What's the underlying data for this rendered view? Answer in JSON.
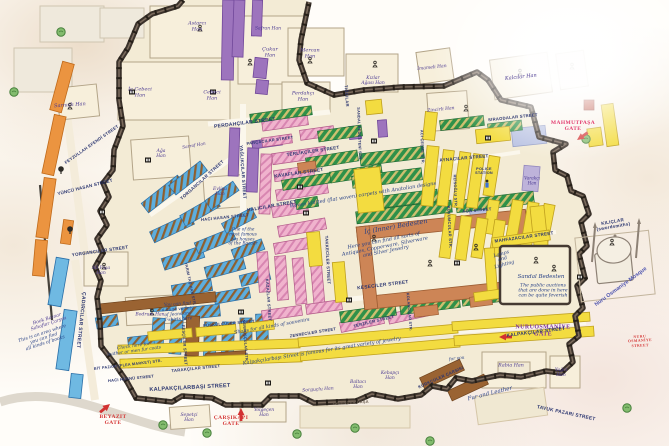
{
  "ic_bedesten": {
    "title": "İç (Inner) Bedesten",
    "note": "Here you can find all sorts of\nAntiques, Copperware, Silverware\nand Silver Jewelry"
  },
  "sandal_bedesten": {
    "title": "Sandal Bedesten",
    "note": "The public auctions\nthat are done in here\ncan be quite feverish"
  },
  "notes": {
    "carpets": "Woven knitted (flat woven) carpets with Anatolian designs",
    "jewelry": "Kalpakçılarbaşı Street is famous for its great variety of jewelry"
  },
  "mosque": {
    "label": "Nuru Osmaniye Mosque"
  },
  "colors": {
    "street_text": "#2a3570",
    "han_text": "#4b3a92",
    "note_text": "#274086",
    "gate_red": "#d43333",
    "gate_magenta": "#e23b6e",
    "gate_purple": "#7b2fa0",
    "yellow": "#f3dc40",
    "pink": "#f0b3cd",
    "green": "#2f9149",
    "blue": "#5caede",
    "purple": "#9d74bd",
    "orange": "#eb9440",
    "brick": "#cd8556",
    "wall": "#3b322b"
  },
  "labels": [
    {
      "cls": "gate",
      "name": "gate-label",
      "items": [
        {
          "t": "MAHMUTPAŞA\nGATE",
          "x": 573,
          "y": 126,
          "c": "#e23b6e",
          "fs": 5.5
        },
        {
          "t": "NURUOSMANİYE\nGATE",
          "x": 543,
          "y": 331,
          "c": "#7b2fa0",
          "fs": 6
        },
        {
          "t": "BEYAZIT\nGATE",
          "x": 113,
          "y": 420,
          "c": "#d43333",
          "fs": 5.5
        },
        {
          "t": "ÇARŞIKAPI\nGATE",
          "x": 231,
          "y": 421,
          "c": "#d43333",
          "fs": 5.5
        },
        {
          "t": "NURU OSMANİYE STREET",
          "x": 640,
          "y": 341,
          "c": "#d43333",
          "fs": 3.8,
          "r": -3
        }
      ]
    },
    {
      "cls": "st",
      "name": "street-label",
      "items": [
        {
          "t": "PERDAHÇILAR STREET",
          "x": 245,
          "y": 124,
          "r": -7,
          "fs": 5
        },
        {
          "t": "PARÇACILAR STREET",
          "x": 270,
          "y": 141,
          "r": -8,
          "fs": 4
        },
        {
          "t": "TERLİKÇİLER STREET",
          "x": 313,
          "y": 151,
          "r": -8,
          "fs": 4.5
        },
        {
          "t": "KAVAFLAR STREET",
          "x": 299,
          "y": 174,
          "r": -8,
          "fs": 4.8
        },
        {
          "t": "HALICILAR STREET",
          "x": 272,
          "y": 207,
          "r": -10,
          "fs": 4.8
        },
        {
          "t": "YAĞLIKÇILAR STREET",
          "x": 243,
          "y": 172,
          "r": 86,
          "fs": 4.5
        },
        {
          "t": "TIĞCILAR",
          "x": 346,
          "y": 96,
          "r": 86,
          "fs": 4.2
        },
        {
          "t": "SIRAODALAR STREET",
          "x": 513,
          "y": 118,
          "r": -6,
          "fs": 4.2
        },
        {
          "t": "AYNACILAR STREET",
          "x": 464,
          "y": 158,
          "r": -5,
          "fs": 4.5
        },
        {
          "t": "AĞA STREET",
          "x": 477,
          "y": 211,
          "r": -5,
          "fs": 4.2
        },
        {
          "t": "MAHFAZACILAR STREET",
          "x": 524,
          "y": 237,
          "r": -8,
          "fs": 4.5
        },
        {
          "t": "KILIÇLAR (swordsmiths)",
          "x": 613,
          "y": 224,
          "r": -10,
          "fs": 4.5
        },
        {
          "t": "KUYUMCULAR STR.",
          "x": 449,
          "y": 227,
          "r": 87,
          "fs": 4
        },
        {
          "t": "REİSOĞLU STR.",
          "x": 455,
          "y": 191,
          "r": 88,
          "fs": 3.8
        },
        {
          "t": "SERPUŞÇULAR STR.",
          "x": 245,
          "y": 341,
          "r": 86,
          "fs": 3.8
        },
        {
          "t": "FESÇİLER STREET",
          "x": 184,
          "y": 345,
          "r": 86,
          "fs": 4
        },
        {
          "t": "TARAKÇILAR STREET",
          "x": 196,
          "y": 369,
          "r": -6,
          "fs": 4.2
        },
        {
          "t": "HACI HÜSNÜ STREET",
          "x": 131,
          "y": 379,
          "r": -6,
          "fs": 4
        },
        {
          "t": "BİT PAZARI (FLEA MARKET) STR.",
          "x": 128,
          "y": 365,
          "r": -7,
          "fs": 3.8
        },
        {
          "t": "KALPAKÇILARBAŞI STREET",
          "x": 190,
          "y": 388,
          "r": -3,
          "fs": 5.5
        },
        {
          "t": "KALPAKÇILAR STREET",
          "x": 536,
          "y": 333,
          "r": -7,
          "fs": 4.8
        },
        {
          "t": "KESECİLER STREET",
          "x": 383,
          "y": 286,
          "r": -7,
          "fs": 4.8
        },
        {
          "t": "TAKKECİLER STREET",
          "x": 327,
          "y": 260,
          "r": 87,
          "fs": 4.2
        },
        {
          "t": "SANDAL BEDESTENİ STR.",
          "x": 359,
          "y": 134,
          "r": 88,
          "fs": 3.8
        },
        {
          "t": "YORGANCILAR STREET",
          "x": 202,
          "y": 180,
          "r": -42,
          "fs": 4.5
        },
        {
          "t": "YORGANCILAR STREET",
          "x": 100,
          "y": 251,
          "r": -8,
          "fs": 4.5
        },
        {
          "t": "YÜNCÜ HASAN STREET",
          "x": 85,
          "y": 187,
          "r": -14,
          "fs": 4.5
        },
        {
          "t": "FEYZULLAH EFENDİ STREET",
          "x": 92,
          "y": 145,
          "r": -35,
          "fs": 4.2
        },
        {
          "t": "HACI HASAN STREET",
          "x": 225,
          "y": 218,
          "r": -6,
          "fs": 4.2
        },
        {
          "t": "YARIM TAŞ HAN STR.",
          "x": 190,
          "y": 284,
          "r": 78,
          "fs": 3.8
        },
        {
          "t": "PÜSKÜLCÜLER STREET",
          "x": 229,
          "y": 324,
          "r": -5,
          "fs": 4
        },
        {
          "t": "KAZAZLAR STREET",
          "x": 268,
          "y": 300,
          "r": 86,
          "fs": 4
        },
        {
          "t": "ÇADIRCILAR STREET",
          "x": 80,
          "y": 320,
          "r": 96,
          "fs": 5
        },
        {
          "t": "TERZİLER STREET",
          "x": 374,
          "y": 322,
          "r": -14,
          "fs": 4.2
        },
        {
          "t": "ZENNECİLER STREET",
          "x": 313,
          "y": 333,
          "r": -9,
          "fs": 4
        },
        {
          "t": "KOLANCILAR STR.",
          "x": 409,
          "y": 312,
          "r": 85,
          "fs": 3.8
        },
        {
          "t": "KÜRKÇÜLER ÇARŞISI",
          "x": 441,
          "y": 378,
          "r": -24,
          "fs": 4.2
        },
        {
          "t": "TAVUK PAZARI STREET",
          "x": 566,
          "y": 414,
          "r": 12,
          "fs": 4.8
        },
        {
          "t": "ACI ÇEŞME STR.",
          "x": 422,
          "y": 147,
          "r": 88,
          "fs": 3.8
        },
        {
          "t": "İSKENDER PAŞA",
          "x": 351,
          "y": 403,
          "r": -3,
          "fs": 4,
          "c": "#6e6154"
        },
        {
          "t": "POLICE\nSTATION",
          "x": 484,
          "y": 171,
          "fs": 3.8
        }
      ]
    },
    {
      "cls": "han",
      "name": "han-label",
      "items": [
        {
          "t": "Astarcı\nHan",
          "x": 197,
          "y": 27
        },
        {
          "t": "Sarnıçlı Han",
          "x": 70,
          "y": 106,
          "r": -4
        },
        {
          "t": "İç Cebeci\nHan",
          "x": 140,
          "y": 93
        },
        {
          "t": "Cebeci\nHan",
          "x": 212,
          "y": 96
        },
        {
          "t": "Safran Han",
          "x": 268,
          "y": 29,
          "fs": 4.5
        },
        {
          "t": "Çukur\nHan",
          "x": 270,
          "y": 53
        },
        {
          "t": "Mercan\nHan",
          "x": 310,
          "y": 54
        },
        {
          "t": "Perdahçı\nHan",
          "x": 303,
          "y": 97
        },
        {
          "t": "Kızlar\nAğası Han",
          "x": 373,
          "y": 81,
          "fs": 4.5
        },
        {
          "t": "İmameli Han",
          "x": 432,
          "y": 68,
          "r": -6,
          "fs": 4.5
        },
        {
          "t": "Zincirli Han",
          "x": 441,
          "y": 110,
          "r": -6,
          "fs": 4.5
        },
        {
          "t": "Kalcılar Han",
          "x": 521,
          "y": 78,
          "r": -6
        },
        {
          "t": "Evliya\nHan",
          "x": 220,
          "y": 192,
          "fs": 4.5
        },
        {
          "t": "Ağa\nHan",
          "x": 161,
          "y": 154,
          "fs": 4.5
        },
        {
          "t": "Sarraf Han",
          "x": 194,
          "y": 146,
          "r": -10,
          "fs": 4.2
        },
        {
          "t": "Ali Paşa\nHan",
          "x": 101,
          "y": 271,
          "fs": 4.5
        },
        {
          "t": "Bodrum Han",
          "x": 150,
          "y": 315,
          "fs": 4.5
        },
        {
          "t": "Sepetçi\nHan",
          "x": 189,
          "y": 418,
          "fs": 4.5
        },
        {
          "t": "Yolgeçen\nHan",
          "x": 264,
          "y": 413,
          "fs": 4.5
        },
        {
          "t": "Sorguçlu Han",
          "x": 318,
          "y": 390,
          "r": -4,
          "fs": 4.5
        },
        {
          "t": "Baltacı\nHan",
          "x": 358,
          "y": 385,
          "fs": 4.5
        },
        {
          "t": "Kebapçı\nHan",
          "x": 390,
          "y": 376,
          "fs": 4.5
        },
        {
          "t": "Rabia Han",
          "x": 511,
          "y": 366,
          "fs": 4.8
        },
        {
          "t": "Yağcı\nHan",
          "x": 561,
          "y": 373,
          "fs": 4.5
        },
        {
          "t": "Varakçı\nHan",
          "x": 532,
          "y": 181,
          "fs": 4.2
        },
        {
          "t": "Book Bazaar\nSahaflar Çarşısı",
          "x": 48,
          "y": 322,
          "r": -18,
          "fs": 4.6
        }
      ]
    },
    {
      "cls": "note",
      "name": "annotation",
      "items": [
        {
          "t": "Shops for all kinds of souvenirs",
          "x": 272,
          "y": 327,
          "r": -10,
          "fs": 4.8
        },
        {
          "t": "You can find\na huge variety\nof Jeans and\nT-shirts here",
          "x": 178,
          "y": 313,
          "r": -4,
          "fs": 4.4
        },
        {
          "t": "Check here for\nleather or men fur coats",
          "x": 134,
          "y": 350,
          "r": -8,
          "fs": 4.4
        },
        {
          "t": "This is an area where\nyou can find\nall kinds of books",
          "x": 44,
          "y": 339,
          "r": -18,
          "fs": 4.6
        },
        {
          "t": "One of the\nmost famous\ntea houses\nof the Bazaar",
          "x": 243,
          "y": 238,
          "fs": 4.3
        },
        {
          "t": "Lamps\nand\nLighting",
          "x": 503,
          "y": 260,
          "r": -16,
          "fs": 4.8
        },
        {
          "t": "Fur and Leather",
          "x": 490,
          "y": 394,
          "r": -14,
          "fs": 5.5
        },
        {
          "t": "for you",
          "x": 457,
          "y": 360,
          "r": -8,
          "fs": 4.4
        }
      ]
    }
  ]
}
